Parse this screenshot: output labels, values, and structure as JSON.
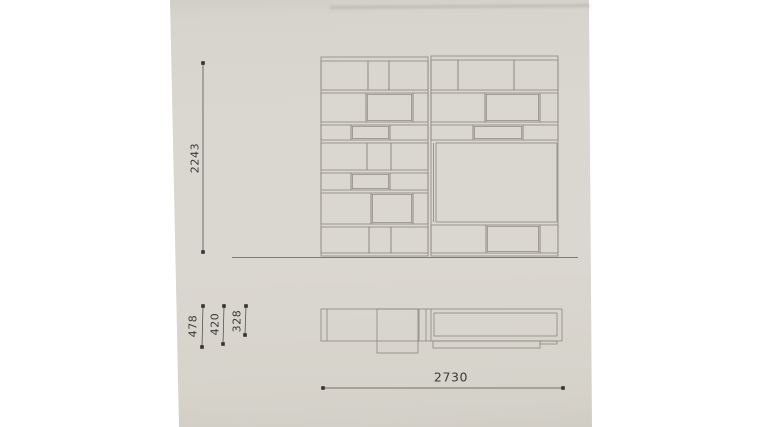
{
  "colors": {
    "paper": "#d8d5ce",
    "line": "#8a877e",
    "line_dark": "#7b786f",
    "dim_line": "#55524b",
    "dot": "#35332f",
    "text": "#3c3a35"
  },
  "dimensions": {
    "height": {
      "value": "2243",
      "orientation": "vertical"
    },
    "depth_478": {
      "value": "478",
      "orientation": "vertical"
    },
    "depth_420": {
      "value": "420",
      "orientation": "vertical"
    },
    "depth_328": {
      "value": "328",
      "orientation": "vertical"
    },
    "width": {
      "value": "2730",
      "orientation": "horizontal"
    }
  },
  "geometry": {
    "front_elevation": {
      "units": [
        {
          "name": "left-unit",
          "outline": [
            321,
            57,
            428,
            256
          ],
          "rows": [
            {
              "y1": 61,
              "y2": 90,
              "cols": [
                321,
                368,
                389,
                428
              ]
            },
            {
              "y1": 93,
              "y2": 122,
              "cols": [
                321,
                366,
                413,
                428
              ],
              "box": 1
            },
            {
              "y1": 125,
              "y2": 140,
              "cols": [
                321,
                351,
                390,
                428
              ],
              "box": 1
            },
            {
              "y1": 143,
              "y2": 170,
              "cols": [
                321,
                367,
                391,
                428
              ]
            },
            {
              "y1": 173,
              "y2": 190,
              "cols": [
                321,
                351,
                390,
                428
              ],
              "box": 1
            },
            {
              "y1": 193,
              "y2": 224,
              "cols": [
                321,
                371,
                413,
                428
              ],
              "box": 1
            },
            {
              "y1": 227,
              "y2": 253,
              "cols": [
                321,
                369,
                391,
                428
              ]
            }
          ],
          "extra_lines": []
        },
        {
          "name": "right-unit",
          "outline": [
            431,
            56,
            558,
            256
          ],
          "rows": [
            {
              "y1": 60,
              "y2": 90,
              "cols": [
                431,
                458,
                514,
                558
              ]
            },
            {
              "y1": 93,
              "y2": 122,
              "cols": [
                431,
                485,
                540,
                558
              ],
              "box": 1
            },
            {
              "y1": 125,
              "y2": 140,
              "cols": [
                431,
                473,
                523,
                558
              ],
              "box": 1
            },
            {
              "y1": 143,
              "y2": 222,
              "cols": [
                436,
                557
              ]
            },
            {
              "y1": 225,
              "y2": 253,
              "cols": [
                431,
                486,
                540,
                558
              ],
              "box": 1
            }
          ],
          "extra_lines": [
            [
              433.5,
              143,
              433.5,
              222
            ]
          ]
        }
      ],
      "floor_line": [
        232,
        257.5,
        578,
        257.5
      ]
    },
    "plan_view": {
      "outline": [
        321,
        309,
        562,
        341
      ],
      "inner_lines": [
        [
          327,
          309,
          327,
          341
        ],
        [
          419,
          309,
          419,
          341
        ],
        [
          426,
          309,
          426,
          341
        ],
        [
          431,
          309,
          431,
          341
        ]
      ],
      "deep_box": [
        377,
        309,
        418,
        353
      ],
      "right_panel": [
        434,
        313,
        557,
        336
      ],
      "bench": [
        433,
        341,
        540,
        348
      ],
      "bench_step": [
        540,
        341,
        557,
        344
      ]
    },
    "dimension_lines": [
      {
        "id": "height",
        "x1": 203,
        "y1": 63,
        "x2": 203,
        "y2": 252
      },
      {
        "id": "depth_478",
        "x1": 203,
        "y1": 306,
        "x2": 202,
        "y2": 347
      },
      {
        "id": "depth_420",
        "x1": 224,
        "y1": 306,
        "x2": 223,
        "y2": 344
      },
      {
        "id": "depth_328",
        "x1": 246,
        "y1": 306,
        "x2": 245,
        "y2": 335
      },
      {
        "id": "width",
        "x1": 323,
        "y1": 388,
        "x2": 563,
        "y2": 388
      }
    ]
  }
}
